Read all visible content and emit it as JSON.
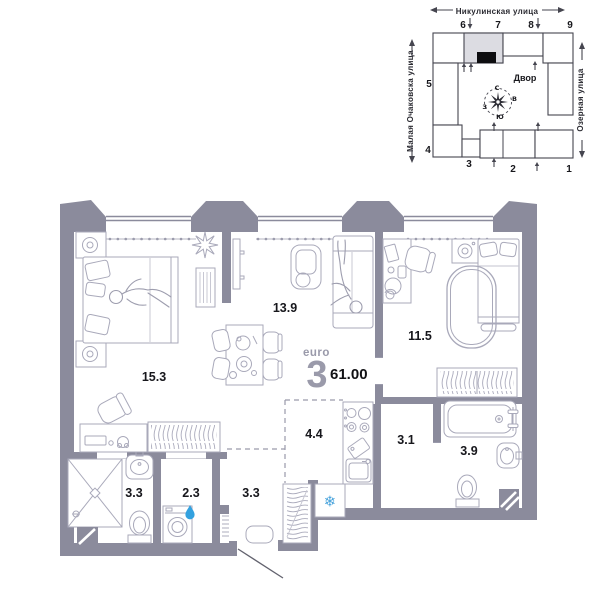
{
  "site_plan": {
    "street_top": "Никулинская улица",
    "street_left": "Малая Очаковска улица",
    "street_right": "Озерная улица",
    "courtyard": "Двор",
    "compass": {
      "n": "С",
      "e": "В",
      "w": "З",
      "s": "Ю"
    },
    "sections": {
      "s1": "1",
      "s2": "2",
      "s3": "3",
      "s4": "4",
      "s5": "5",
      "s6": "6",
      "s7": "7",
      "s8": "8",
      "s9": "9"
    }
  },
  "apartment": {
    "type_label": "euro",
    "rooms_count": "3",
    "total_area": "61.00",
    "areas": {
      "bedroom_main": "15.3",
      "living_room": "13.9",
      "bedroom_second": "11.5",
      "kitchen_zone": "4.4",
      "inner_hall": "3.1",
      "bathroom": "3.9",
      "shower_room": "3.3",
      "laundry": "2.3",
      "hallway": "3.3"
    }
  },
  "icons": {
    "fridge_snowflake": "❄"
  }
}
